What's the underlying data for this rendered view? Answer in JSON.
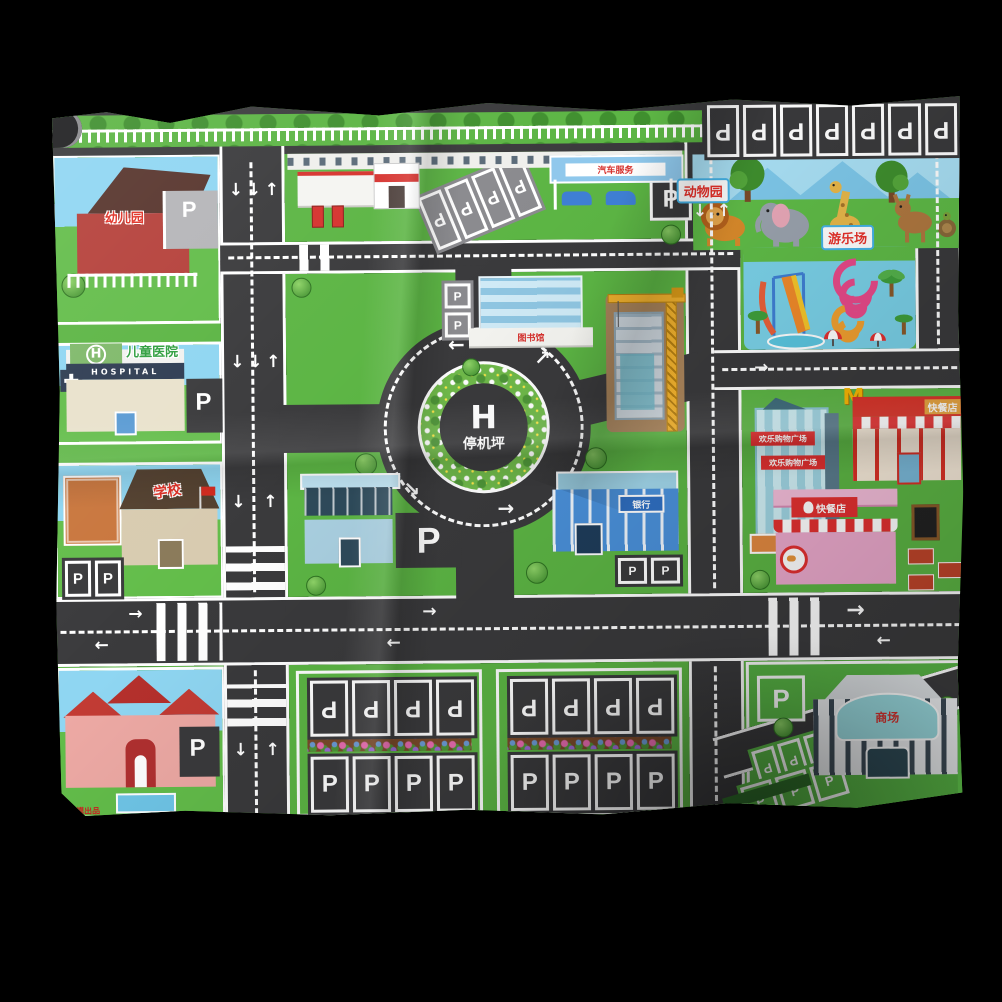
{
  "photo": {
    "background": "#000000"
  },
  "map": {
    "colors": {
      "road": "#3a3a3c",
      "grass": "#5cb544",
      "sky": "#8fd6f2",
      "marking": "#ffffff",
      "accent_red": "#e8312a"
    },
    "center": {
      "helipad_letter": "H",
      "helipad_label": "停机坪"
    },
    "road": {
      "parking_letter": "P",
      "arrow_left": "←",
      "arrow_right": "→",
      "arrow_up": "↑",
      "arrow_down": "↓",
      "arrow_up_right": "↗",
      "arrow_down_right": "↘"
    },
    "zones": {
      "zoo": {
        "label": "动物园"
      },
      "playground": {
        "label": "游乐场"
      },
      "kindergarten": {
        "label": "幼儿园"
      },
      "hospital": {
        "label_cn": "儿童医院",
        "label_en": "HOSPITAL",
        "roof_letter": "H"
      },
      "school": {
        "label": "学校"
      },
      "bank": {
        "label": "银行"
      },
      "library": {
        "label": "图书馆"
      },
      "car_service": {
        "label": "汽车服务"
      },
      "shopping_tower": {
        "banner_top": "欢乐购物广场",
        "banner_bottom": "欢乐购物广场"
      },
      "burger_restaurant": {
        "logo_letter": "M",
        "label": "快餐店"
      },
      "chicken_restaurant": {
        "label": "快餐店"
      },
      "mall": {
        "label": "商场"
      },
      "apartment": {
        "credit": "车模出品"
      }
    }
  }
}
